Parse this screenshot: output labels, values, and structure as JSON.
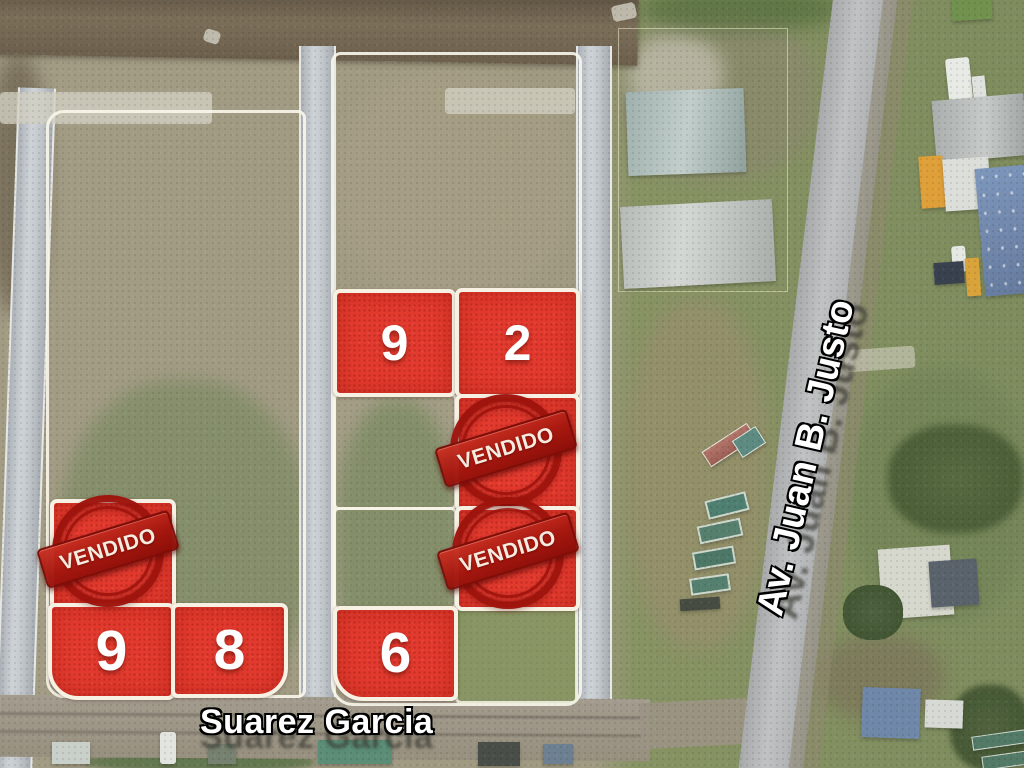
{
  "map": {
    "streets": {
      "bottom_label": "Suarez Garcia",
      "side_label": "Av. Juan B. Justo"
    },
    "stamps": [
      {
        "text": "VENDIDO"
      },
      {
        "text": "VENDIDO"
      },
      {
        "text": "VENDIDO"
      }
    ],
    "lots": [
      {
        "label": "9",
        "status": "available",
        "position": "right-block-row1-left"
      },
      {
        "label": "2",
        "status": "available",
        "position": "right-block-row1-right"
      },
      {
        "label": "",
        "status": "sold",
        "position": "right-block-row2-right"
      },
      {
        "label": "",
        "status": "sold",
        "position": "right-block-row3-right"
      },
      {
        "label": "",
        "status": "sold",
        "position": "left-block-middle"
      },
      {
        "label": "9",
        "status": "available",
        "position": "left-block-bottom-left"
      },
      {
        "label": "8",
        "status": "available",
        "position": "left-block-bottom-right"
      },
      {
        "label": "6",
        "status": "available",
        "position": "right-block-row4-left"
      }
    ],
    "colors": {
      "lot_fill": "#e23a2e",
      "lot_border": "#f7f1e3",
      "stamp_red": "#9e140d",
      "label_text": "#ffffff",
      "label_outline": "#0e0e0c"
    }
  }
}
